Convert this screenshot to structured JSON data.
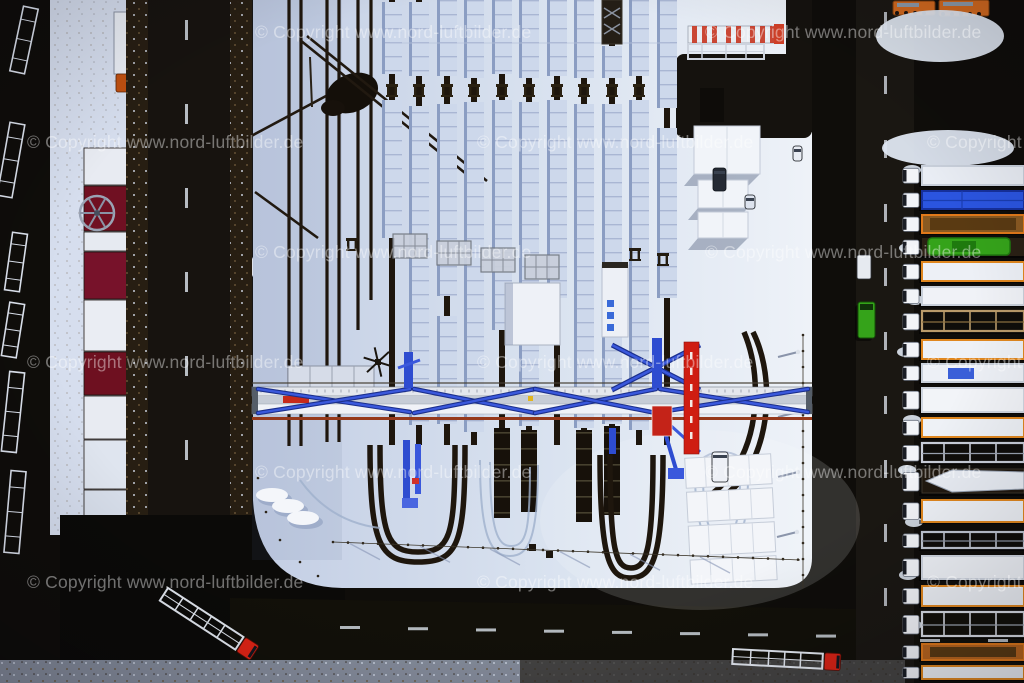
{
  "image": {
    "kind": "winter aerial photograph",
    "subject": "snow-covered railway container terminal with gantry crane, sidings of snow-covered freight trains, access roads and rows of parked trucks",
    "width": 1024,
    "height": 683
  },
  "watermark": {
    "text": "© Copyright www.nord-luftbilder.de",
    "color": "rgba(255,255,255,0.42)",
    "font_size_px": 17.5,
    "positions": [
      {
        "x": 255,
        "y": 22
      },
      {
        "x": 705,
        "y": 22
      },
      {
        "x": 27,
        "y": 132
      },
      {
        "x": 477,
        "y": 132
      },
      {
        "x": 927,
        "y": 132
      },
      {
        "x": 255,
        "y": 242
      },
      {
        "x": 705,
        "y": 242
      },
      {
        "x": 27,
        "y": 352
      },
      {
        "x": 477,
        "y": 352
      },
      {
        "x": 927,
        "y": 352
      },
      {
        "x": 255,
        "y": 462
      },
      {
        "x": 705,
        "y": 462
      },
      {
        "x": 27,
        "y": 572
      },
      {
        "x": 477,
        "y": 572
      },
      {
        "x": 927,
        "y": 572
      }
    ]
  },
  "scene": {
    "palette": {
      "ground": "#0f0d0a",
      "road_left": "#17130f",
      "road_bottom": "#121009",
      "road_right": "#1a1712",
      "junction": "#0b0a08",
      "snow_yard_w": "#c3cee4",
      "snow_yard_m": "#dae3f0",
      "snow_yard_e": "#eef2f8",
      "snow_strip": "#d6deee",
      "snow_bright": "#f4f6fa",
      "track": "#1e160d",
      "train_snow": "#cdd8eb",
      "train_shadow": "#8b9dc2",
      "wagon_line": "#a9b6d3",
      "dark_wagon": "#17110a",
      "tree_band": "#271e12",
      "crane_blue": "#2e4cd0",
      "crane_blue_dark": "#1b2f8c",
      "beam": "#e9ebf0",
      "rust": "#96391b",
      "red": "#d81e12",
      "dark_red": "#701022",
      "orange": "#d2691e",
      "green_truck": "#35a31a",
      "blue_tarp": "#2b55e0",
      "dash": "#d4dae2"
    },
    "yard": {
      "path": "M252,0 H812 V558 Q812,588 774,588 H342 Q258,586 253,500 V0 Z"
    },
    "empty_tracks": [
      {
        "x": 289,
        "y2": 446
      },
      {
        "x": 301,
        "y2": 446
      },
      {
        "x": 327,
        "y2": 442
      },
      {
        "x": 339,
        "y2": 442
      },
      {
        "x": 358,
        "y2": 330
      },
      {
        "x": 371,
        "y2": 300
      }
    ],
    "train_tracks": [
      {
        "x": 392,
        "sn": [
          [
            2,
            74
          ],
          [
            100,
            238
          ]
        ],
        "dk": []
      },
      {
        "x": 419,
        "sn": [
          [
            2,
            76
          ],
          [
            106,
            425
          ]
        ],
        "dk": []
      },
      {
        "x": 447,
        "sn": [
          [
            0,
            76
          ],
          [
            104,
            296
          ],
          [
            316,
            424
          ]
        ],
        "dk": []
      },
      {
        "x": 474,
        "sn": [
          [
            0,
            78
          ],
          [
            102,
            432
          ]
        ],
        "dk": []
      },
      {
        "x": 502,
        "sn": [
          [
            0,
            74
          ],
          [
            100,
            330
          ]
        ],
        "dk": [
          [
            428,
            518
          ]
        ]
      },
      {
        "x": 529,
        "sn": [
          [
            0,
            78
          ],
          [
            102,
            426
          ]
        ],
        "dk": [
          [
            430,
            512
          ]
        ]
      },
      {
        "x": 557,
        "sn": [
          [
            0,
            76
          ],
          [
            100,
            298
          ]
        ],
        "dk": []
      },
      {
        "x": 584,
        "sn": [
          [
            0,
            78
          ],
          [
            104,
            428
          ]
        ],
        "dk": [
          [
            430,
            522
          ]
        ]
      },
      {
        "x": 612,
        "sn": [
          [
            46,
            78
          ],
          [
            104,
            424
          ]
        ],
        "dk": [
          [
            426,
            515
          ]
        ]
      },
      {
        "x": 639,
        "sn": [
          [
            0,
            76
          ],
          [
            100,
            430
          ]
        ],
        "dk": []
      },
      {
        "x": 667,
        "sn": [
          [
            0,
            108
          ],
          [
            128,
            298
          ]
        ],
        "dk": []
      }
    ],
    "buffer_stops": {
      "y": 84,
      "xs": [
        392,
        419,
        447,
        474,
        502,
        529,
        557,
        584,
        612,
        639
      ]
    },
    "buffer_stops2": [
      [
        352,
        238
      ],
      [
        635,
        248
      ],
      [
        663,
        253
      ]
    ],
    "platforms": [
      [
        393,
        234
      ],
      [
        437,
        241
      ],
      [
        481,
        248
      ],
      [
        525,
        255
      ]
    ],
    "rail_loops": [
      "M370,445 C370,545 380,562 418,562 C458,562 465,545 465,445",
      "M380,445 C380,538 388,552 418,552 C450,552 455,538 455,445",
      "M600,455 C600,560 610,578 630,578 C652,578 663,560 663,455",
      "M610,455 C610,552 616,568 631,568 C646,568 653,552 653,455",
      "M753,332 C772,370 772,430 748,470 C738,488 720,500 700,512",
      "M744,332 C760,370 760,426 738,464 C728,482 714,494 696,504"
    ],
    "tire_loops": [
      "M480,460 C480,540 492,556 510,556 C528,556 538,540 538,465",
      "M490,462 C490,532 498,546 511,546 C526,546 530,532 530,467",
      "M695,470 C695,530 705,545 722,545 C740,545 748,530 748,475",
      "M703,472 C703,524 710,536 722,536 C735,536 740,524 740,477",
      "M300,480 Q330,522 380,528"
    ],
    "diagonals": [
      [
        300,
        40,
        480,
        185
      ],
      [
        307,
        36,
        487,
        181
      ],
      [
        240,
        142,
        326,
        96
      ],
      [
        255,
        192,
        318,
        238
      ]
    ],
    "crane": {
      "x1": 252,
      "x2": 812,
      "legs": [
        412,
        658
      ],
      "braces": [
        [
          258,
          389,
          410,
          412
        ],
        [
          258,
          413,
          410,
          389
        ],
        [
          414,
          389,
          535,
          413
        ],
        [
          535,
          413,
          656,
          389
        ],
        [
          414,
          413,
          535,
          389
        ],
        [
          535,
          389,
          656,
          413
        ],
        [
          660,
          389,
          808,
          412
        ],
        [
          660,
          412,
          808,
          389
        ]
      ],
      "red_tower": {
        "x": 684,
        "y": 342,
        "w": 15,
        "h": 112
      },
      "red_box": {
        "x": 652,
        "y": 406,
        "w": 20,
        "h": 30
      }
    },
    "red_buildings": {
      "x": 84,
      "w": 44,
      "blocks": [
        {
          "y": 148,
          "h": 37,
          "c": "#e8ebf2"
        },
        {
          "y": 186,
          "h": 45,
          "c": "#701022"
        },
        {
          "y": 232,
          "h": 19,
          "c": "#e6eaf1"
        },
        {
          "y": 252,
          "h": 47,
          "c": "#77122a"
        },
        {
          "y": 300,
          "h": 51,
          "c": "#eaedf3"
        },
        {
          "y": 352,
          "h": 43,
          "c": "#6e1020"
        },
        {
          "y": 396,
          "h": 43,
          "c": "#e8ebf2"
        },
        {
          "y": 440,
          "h": 49,
          "c": "#dfe5ef"
        },
        {
          "y": 490,
          "h": 41,
          "c": "#d8dfeb"
        },
        {
          "y": 532,
          "h": 30,
          "c": "#c32014"
        }
      ]
    },
    "parked_truck_top_left": {
      "trailer": {
        "x": 114,
        "y": 12,
        "w": 20,
        "h": 62
      },
      "cab": {
        "x": 116,
        "y": 74,
        "w": 19,
        "h": 18,
        "c": "#c05010"
      }
    },
    "left_trailers": {
      "w": 15,
      "items": [
        {
          "cx": 24,
          "cy": 40,
          "l": 66,
          "a": 12
        },
        {
          "cx": 11,
          "cy": 160,
          "l": 74,
          "a": 10
        },
        {
          "cx": 16,
          "cy": 262,
          "l": 58,
          "a": 8
        },
        {
          "cx": 13,
          "cy": 330,
          "l": 54,
          "a": 9
        },
        {
          "cx": 13,
          "cy": 412,
          "l": 80,
          "a": 6
        },
        {
          "cx": 15,
          "cy": 512,
          "l": 82,
          "a": 5
        }
      ]
    },
    "right_trucks": {
      "cab_x": 903,
      "trailer_x": 922,
      "items": [
        {
          "y": 164,
          "h": 24,
          "kind": "box",
          "body": "#e9edf4",
          "edge": "#c8cfda"
        },
        {
          "y": 189,
          "h": 23,
          "kind": "tarp",
          "body": "#2b55e0",
          "edge": "#16309c"
        },
        {
          "y": 213,
          "h": 23,
          "kind": "open",
          "body": "#8a5a22",
          "edge": "#e0791a"
        },
        {
          "y": 236,
          "h": 23,
          "kind": "machine",
          "body": "#35a31a",
          "edge": "#1e7a0e"
        },
        {
          "y": 260,
          "h": 24,
          "kind": "box",
          "body": "#edf0f6",
          "edge": "#e0871f"
        },
        {
          "y": 285,
          "h": 23,
          "kind": "box",
          "body": "#f0f2f7",
          "edge": "#c9d0da"
        },
        {
          "y": 309,
          "h": 26,
          "kind": "frame",
          "body": "#b99a6a",
          "edge": "#8a7040"
        },
        {
          "y": 338,
          "h": 24,
          "kind": "box",
          "body": "#eef1f6",
          "edge": "#e0871f"
        },
        {
          "y": 362,
          "h": 23,
          "kind": "boxmark",
          "body": "#edf0f6",
          "edge": "#c9d0da",
          "mark": "#3a5fd8"
        },
        {
          "y": 386,
          "h": 29,
          "kind": "box",
          "body": "#f2f4f8",
          "edge": "#d0d6e0"
        },
        {
          "y": 416,
          "h": 24,
          "kind": "box",
          "body": "#eef1f6",
          "edge": "#e0871f"
        },
        {
          "y": 441,
          "h": 25,
          "kind": "frame",
          "body": "#c8cdd8",
          "edge": "#9aa2b0"
        },
        {
          "y": 467,
          "h": 30,
          "kind": "boat",
          "body": "#e9edf4",
          "edge": "#3a342a"
        },
        {
          "y": 498,
          "h": 27,
          "kind": "box",
          "body": "#eef1f6",
          "edge": "#e0871f"
        },
        {
          "y": 530,
          "h": 22,
          "kind": "frame",
          "body": "#c0c6d2",
          "edge": "#8a92a0"
        },
        {
          "y": 554,
          "h": 28,
          "kind": "box",
          "body": "#f0f3f8",
          "edge": "#d0d6e0"
        },
        {
          "y": 584,
          "h": 25,
          "kind": "box",
          "body": "#eef1f6",
          "edge": "#e0871f"
        },
        {
          "y": 610,
          "h": 30,
          "kind": "frame",
          "body": "#d8dce4",
          "edge": "#a0a8b4"
        },
        {
          "y": 642,
          "h": 21,
          "kind": "open",
          "body": "#b8651e",
          "edge": "#e0791a"
        },
        {
          "y": 664,
          "h": 18,
          "kind": "box",
          "body": "#eef1f6",
          "edge": "#e0871f"
        }
      ]
    },
    "snow_blobs": [
      [
        912,
        170
      ],
      [
        908,
        248
      ],
      [
        915,
        300
      ],
      [
        906,
        352
      ],
      [
        912,
        420
      ],
      [
        907,
        470
      ],
      [
        914,
        522
      ],
      [
        908,
        575
      ],
      [
        913,
        625
      ]
    ],
    "orange_trucks": [
      {
        "x": 893,
        "y": 1,
        "w": 42,
        "h": 14
      },
      {
        "x": 939,
        "y": 0,
        "w": 50,
        "h": 16
      }
    ],
    "yard_vehicles": [
      {
        "x": 713,
        "y": 168,
        "w": 13,
        "h": 23,
        "c": "#252a34",
        "name": "dark-suv"
      },
      {
        "x": 793,
        "y": 146,
        "w": 9,
        "h": 15,
        "c": "#e8ecf3",
        "name": "white-car"
      },
      {
        "x": 745,
        "y": 195,
        "w": 10,
        "h": 14,
        "c": "#dde3ee",
        "name": "white-car"
      },
      {
        "x": 712,
        "y": 452,
        "w": 16,
        "h": 30,
        "c": "#edf0f6",
        "name": "white-truck"
      }
    ],
    "road_vehicles": {
      "green_truck": {
        "x": 858,
        "y": 302,
        "w": 17,
        "h": 36
      },
      "white_van": {
        "x": 857,
        "y": 255,
        "w": 14,
        "h": 24
      }
    },
    "bottom_trucks": [
      {
        "x": 168,
        "y": 588,
        "angle": 33,
        "trailer_l": 90,
        "cab": "#e02415"
      },
      {
        "x": 733,
        "y": 649,
        "angle": 3,
        "trailer_l": 90,
        "cab": "#d82315"
      }
    ],
    "light_poles": [
      [
        798,
        352
      ],
      [
        798,
        412
      ],
      [
        798,
        472
      ],
      [
        797,
        532
      ]
    ],
    "dark_squares": [
      [
        529,
        544
      ],
      [
        546,
        551
      ]
    ],
    "sheds_top": [
      {
        "x": 694,
        "y": 126,
        "w": 66,
        "h": 48
      },
      {
        "x": 698,
        "y": 180,
        "w": 50,
        "h": 28
      },
      {
        "x": 698,
        "y": 212,
        "w": 50,
        "h": 26
      }
    ],
    "sheds_bottom": [
      {
        "x": 688,
        "y": 456,
        "w": 86,
        "h": 30
      },
      {
        "x": 688,
        "y": 490,
        "w": 86,
        "h": 30
      },
      {
        "x": 688,
        "y": 524,
        "w": 86,
        "h": 30
      },
      {
        "x": 688,
        "y": 558,
        "w": 86,
        "h": 24
      }
    ],
    "snow_piles": [
      [
        272,
        495
      ],
      [
        288,
        506
      ],
      [
        303,
        518
      ]
    ],
    "container_row_top": {
      "x": 688,
      "y": 26,
      "w": 92,
      "h": 17,
      "stripes": [
        4,
        14,
        24,
        38,
        48,
        62,
        72,
        82
      ]
    },
    "lattice_trailer_top": {
      "x": 688,
      "y": 44,
      "w": 76,
      "h": 15
    },
    "mast_wheel": {
      "cx": 97,
      "cy": 213,
      "r": 17
    },
    "mast_pole": {
      "x1": 150,
      "y1": 232,
      "x2": 247,
      "y2": 268,
      "pad": [
        238,
        258,
        20,
        18
      ]
    }
  }
}
